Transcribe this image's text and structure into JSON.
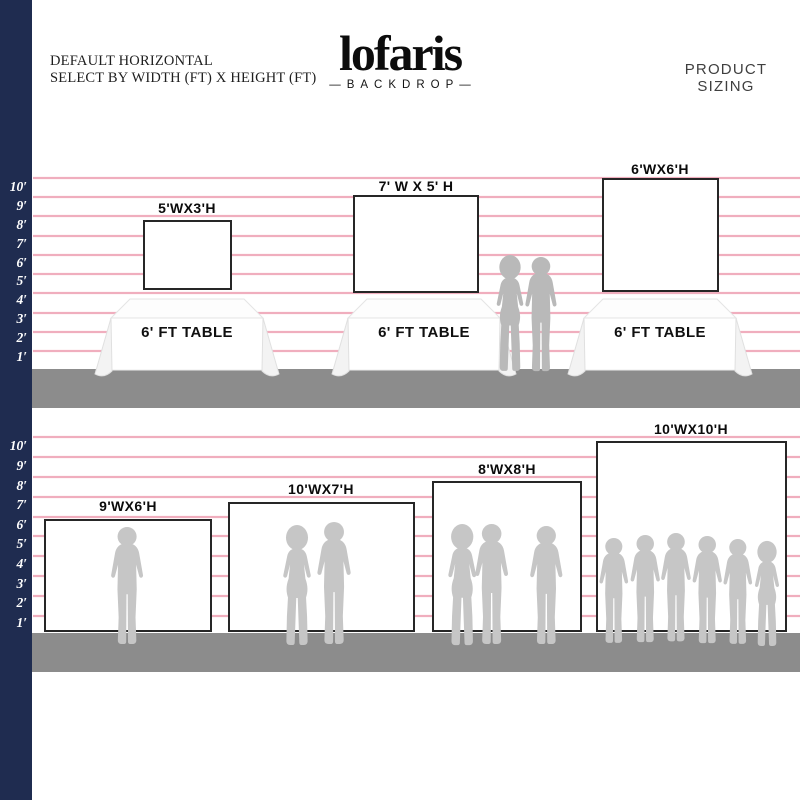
{
  "header": {
    "line1": "DEFAULT HORIZONTAL",
    "line2": "SELECT BY WIDTH (FT) X HEIGHT (FT)",
    "right_label": "PRODUCT SIZING"
  },
  "logo": {
    "name": "lofaris",
    "dash": "—",
    "tagline": "BACKDROP"
  },
  "ruler": {
    "labels": [
      "10′",
      "9′",
      "8′",
      "7′",
      "6′",
      "5′",
      "4′",
      "3′",
      "2′",
      "1′"
    ]
  },
  "row1": {
    "backdrops": [
      {
        "label": "5'WX3'H"
      },
      {
        "label": "7' W X 5' H"
      },
      {
        "label": "6'WX6'H"
      }
    ],
    "tables": [
      {
        "label": "6' FT TABLE"
      },
      {
        "label": "6' FT TABLE"
      },
      {
        "label": "6' FT TABLE"
      }
    ]
  },
  "row2": {
    "backdrops": [
      {
        "label": "9'WX6'H"
      },
      {
        "label": "10'WX7'H"
      },
      {
        "label": "8'WX8'H"
      },
      {
        "label": "10'WX10'H"
      }
    ]
  },
  "colors": {
    "navy": "#1f2c50",
    "gridline_pink": "#efa6b8",
    "floor_gray": "#8c8c8c",
    "silhouette_front": "#b9b9b9",
    "silhouette_back": "#c6c6c6",
    "backdrop_border": "#262626"
  }
}
